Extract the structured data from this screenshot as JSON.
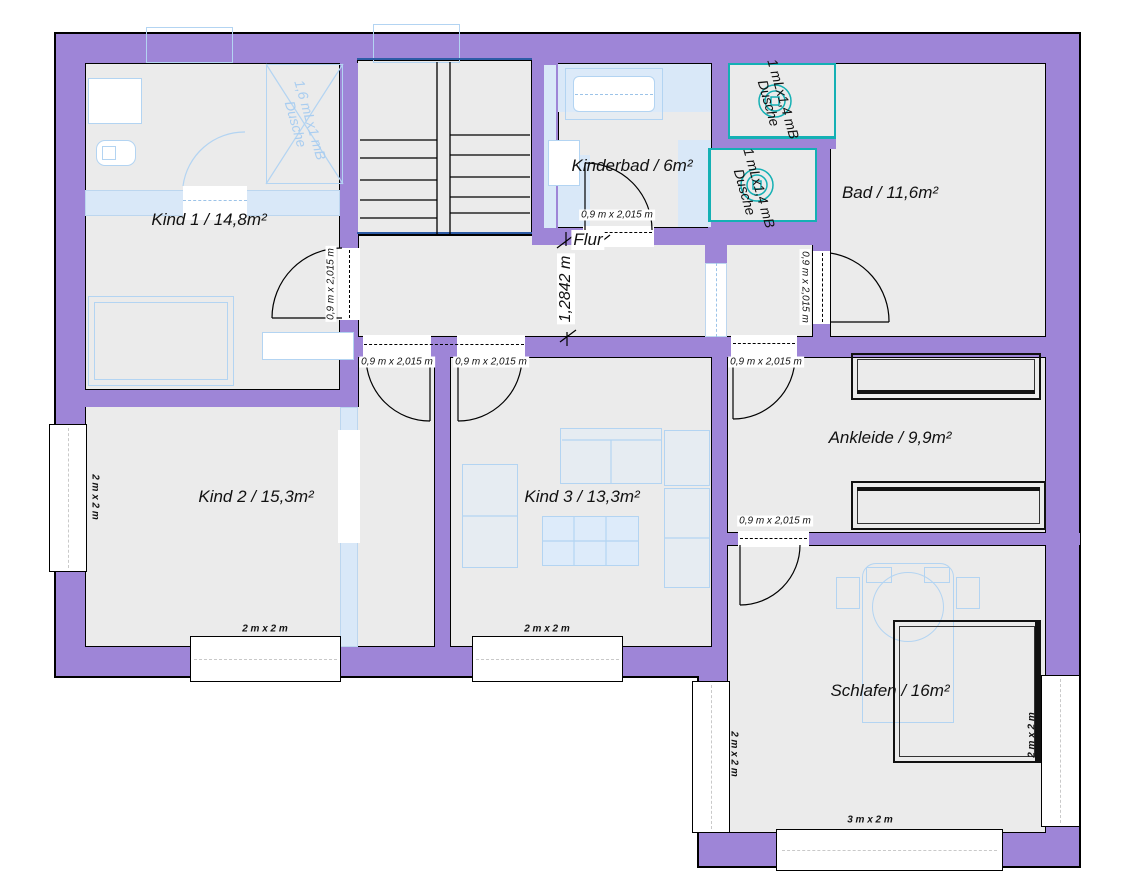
{
  "title": "Obergeschoss Grundriss",
  "colors": {
    "wall": "#9e85d7",
    "floor": "#ebebeb",
    "furniture_line": "#b3d4f2",
    "shower_line": "#14b0b4",
    "stair_line": "#2e5ca6",
    "outline": "#000000"
  },
  "rooms": {
    "kind1": "Kind 1 /  14,8m²",
    "kinderbad": "Kinderbad / 6m²",
    "bad": "Bad / 11,6m²",
    "flur": "Flur",
    "kind2": "Kind 2 / 15,3m²",
    "kind3": "Kind 3 / 13,3m²",
    "ankleide": "Ankleide / 9,9m²",
    "schlafen": "Schlafen / 16m²"
  },
  "labels": {
    "door": "0,9 m x 2,015 m",
    "window_small": "2 m x 2 m",
    "window_large": "3 m x 2 m",
    "flur_width": "1,2842 m",
    "shower_1400": "1 mLx1,4 mB\nDusche",
    "shower_1600": "1,6 mLx1 mB\nDusche"
  }
}
